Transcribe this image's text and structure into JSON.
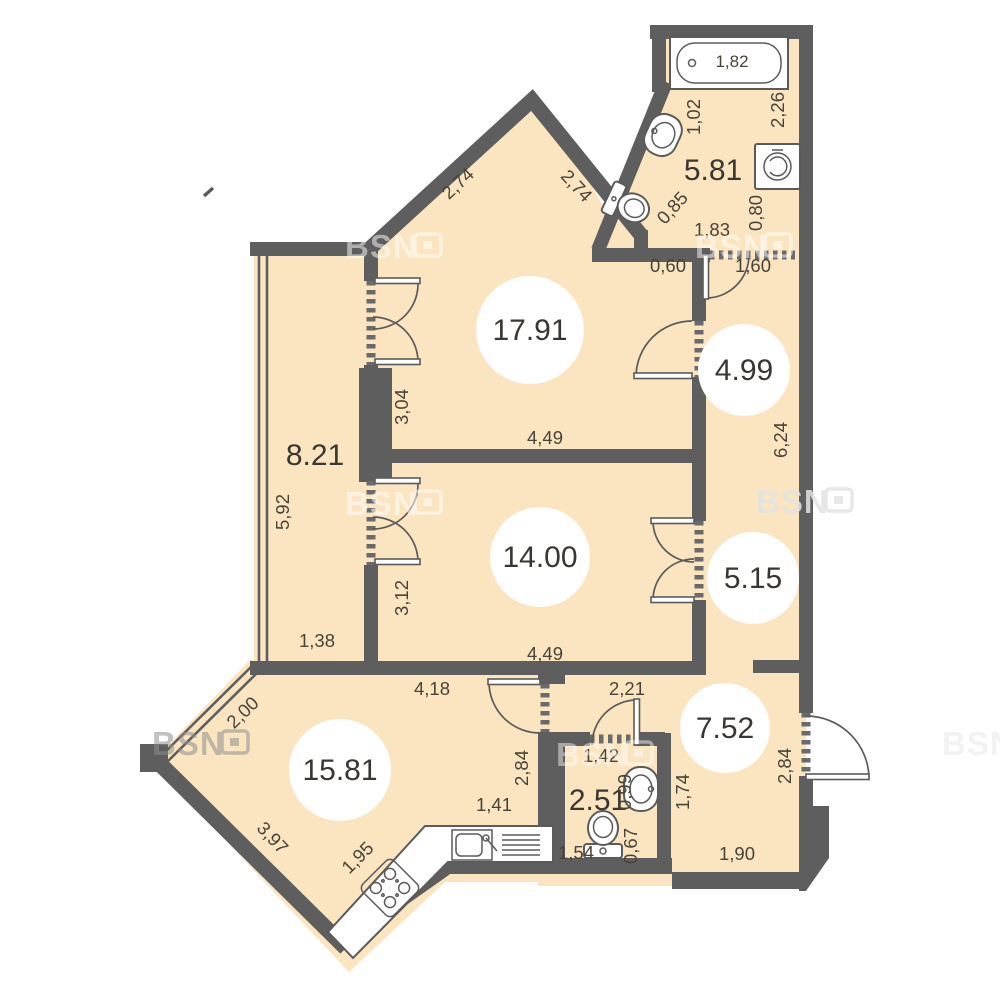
{
  "colors": {
    "floor": "#fbe4c0",
    "wall": "#5f5e5e",
    "dim_text": "#494339",
    "area_text": "#3a3732",
    "white": "#ffffff"
  },
  "watermark": {
    "text": "BSN"
  },
  "rooms": {
    "livingRoom": {
      "area": "17.91"
    },
    "bedroom": {
      "area": "14.00"
    },
    "balcony": {
      "area": "8.21"
    },
    "hallTop": {
      "area": "4.99"
    },
    "hallMid": {
      "area": "5.15"
    },
    "bathroom": {
      "area": "5.81"
    },
    "hallway": {
      "area": "7.52"
    },
    "wc": {
      "area": "2.51"
    },
    "kitchenLiving": {
      "area": "15.81"
    }
  },
  "fixtures": {
    "bathtub_length": "1,82"
  },
  "dims": {
    "peakLeft": "2,74",
    "peakRight": "2,74",
    "bathLeft": "1,02",
    "bathRight": "2,26",
    "bathDiag": "0,85",
    "bathBottom": "1,83",
    "bathRightLower": "0,80",
    "hallTopSeg": "0,60",
    "hallTopDoor": "1,60",
    "livingLeft": "3,04",
    "livingBottom": "4,49",
    "balconyLeft": "5,92",
    "balconyBottom": "1,38",
    "bedroomLeft": "3,12",
    "bedroomBottom": "4,49",
    "corridorRight": "6,24",
    "kitchenTop": "4,18",
    "lobbyTop": "2,21",
    "kitchenWindow": "2,00",
    "kitchenWallRight": "2,84",
    "counterTop": "1,41",
    "counterDiag": "1,95",
    "kitchenDiag": "3,97",
    "wcTop": "1,42",
    "wcSink": "0,99",
    "wcToilet": "0,67",
    "wcBottom": "1,54",
    "wcRight": "1,74",
    "hallwayBottom": "1,90",
    "entryRight": "2,84"
  }
}
